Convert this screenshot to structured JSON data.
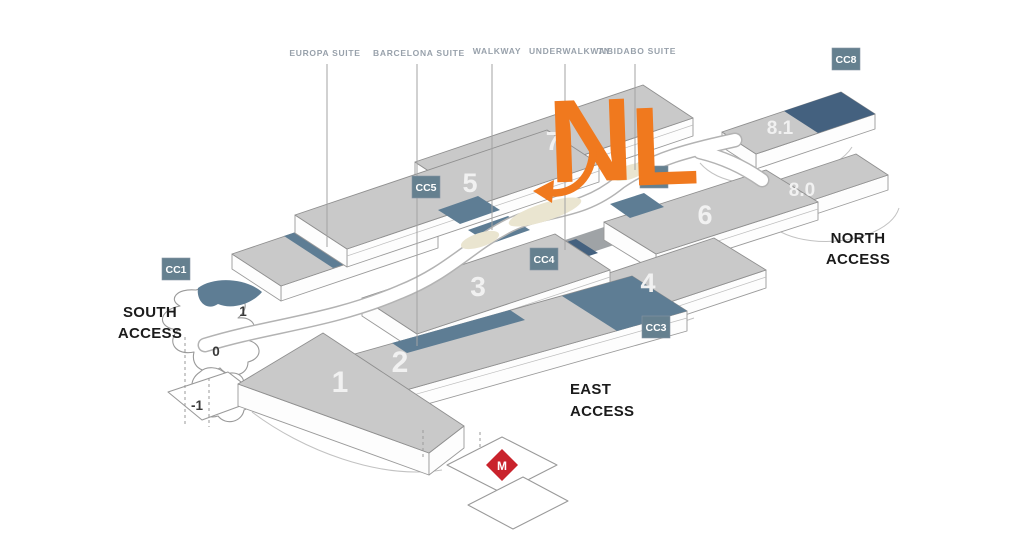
{
  "suites": [
    {
      "label": "EUROPA SUITE"
    },
    {
      "label": "BARCELONA SUITE"
    },
    {
      "label": "WALKWAY"
    },
    {
      "label": "UNDERWALKWAY"
    },
    {
      "label": "TIBIDABO SUITE"
    }
  ],
  "halls": [
    {
      "label": "1"
    },
    {
      "label": "2"
    },
    {
      "label": "3"
    },
    {
      "label": "4"
    },
    {
      "label": "5"
    },
    {
      "label": "6"
    },
    {
      "label": "7"
    },
    {
      "label": "8.1"
    },
    {
      "label": "8.0"
    }
  ],
  "badges": [
    {
      "id": "CC1"
    },
    {
      "id": "CC3"
    },
    {
      "id": "CC4"
    },
    {
      "id": "CC5"
    },
    {
      "id": "CC7"
    },
    {
      "id": "CC8"
    }
  ],
  "access": {
    "south": {
      "line1": "SOUTH",
      "line2": "ACCESS"
    },
    "east": {
      "line1": "EAST",
      "line2": "ACCESS"
    },
    "north": {
      "line1": "NORTH",
      "line2": "ACCESS"
    }
  },
  "levels": [
    {
      "label": "1"
    },
    {
      "label": "0"
    },
    {
      "label": "-1"
    }
  ],
  "logo": {
    "letter1": "N",
    "letter2": "L"
  },
  "metro": {
    "label": "M"
  },
  "colors": {
    "orange": "#F0791E",
    "slate_strip": "#5E7D94",
    "navy_strip": "#44617F",
    "badge_slate": "#65808F",
    "hall_gray": "#C9C9C9",
    "metro_red": "#C9232C"
  }
}
